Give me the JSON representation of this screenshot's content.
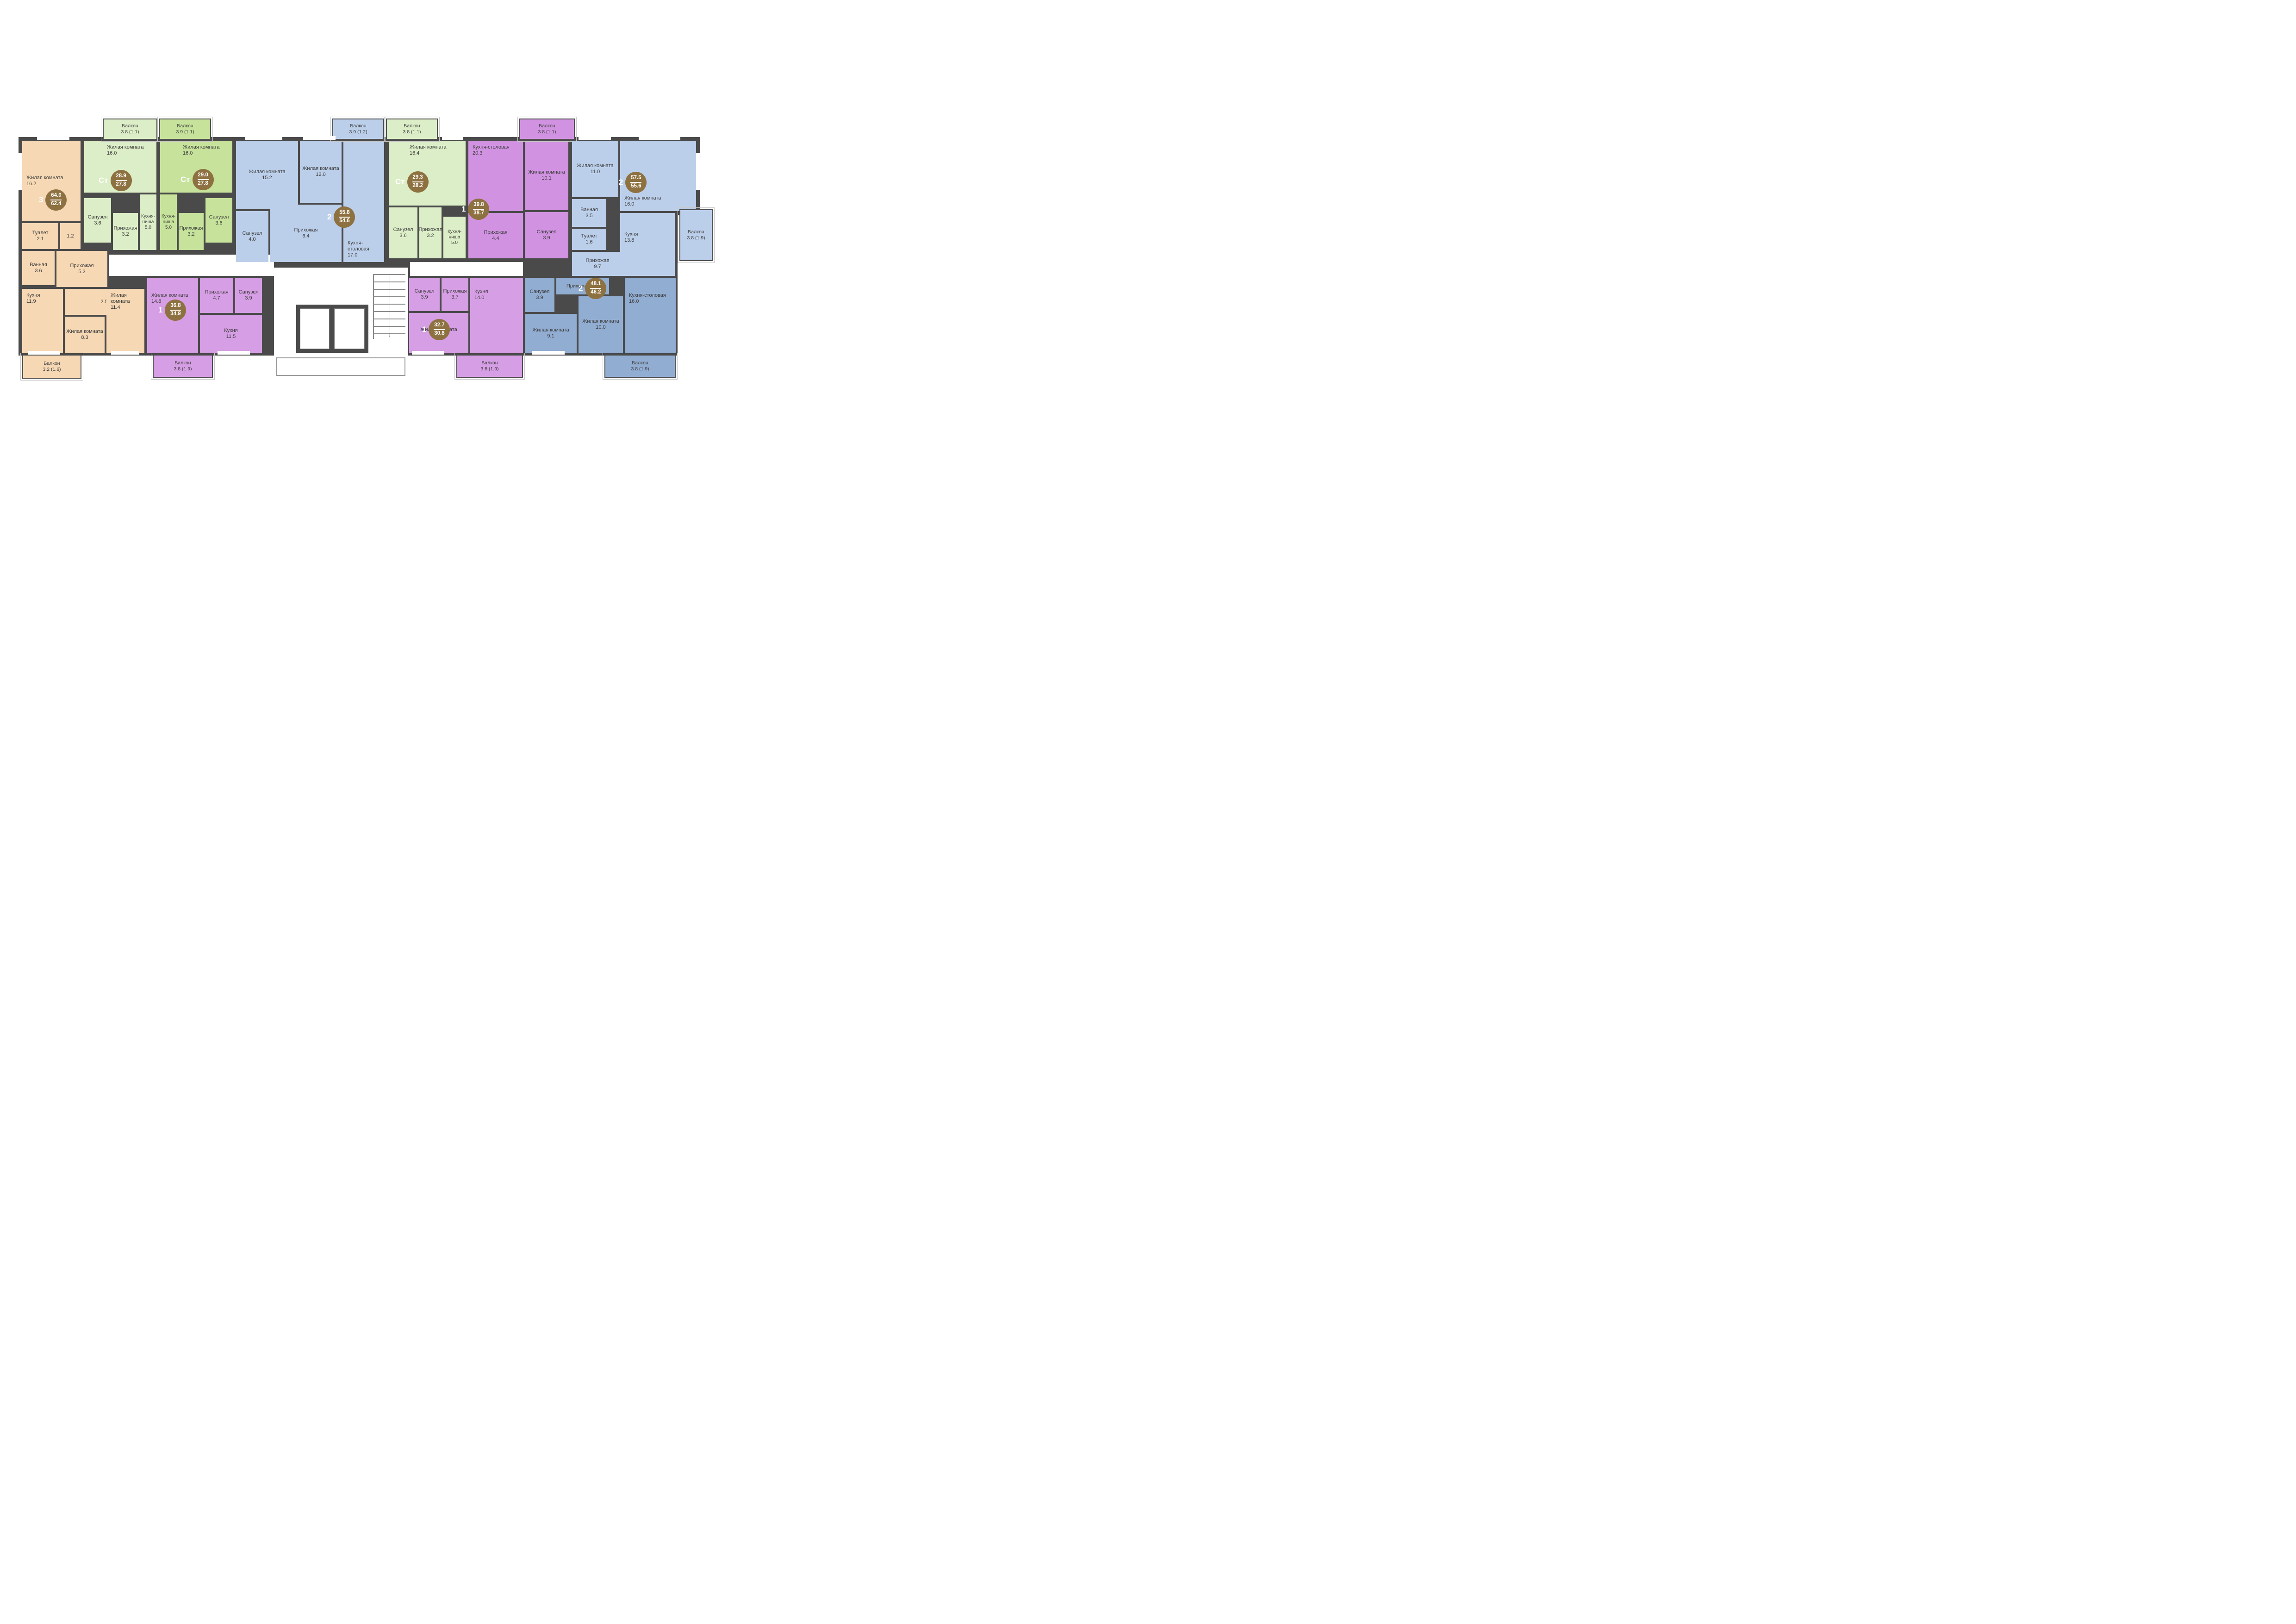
{
  "plan": {
    "wall_color": "#4a4a4a",
    "badge_color": "#8e7140",
    "text_color": "#3c3c3c",
    "apartments": [
      {
        "id": "apt-1",
        "type_label": "3",
        "area_total": "64.0",
        "area_living": "62.4",
        "color": "#f6d8b4",
        "rooms": [
          {
            "name": "Жилая комната",
            "area": "16.2"
          },
          {
            "name": "Туалет",
            "area": "2.1"
          },
          {
            "name": "",
            "area": "1.2"
          },
          {
            "name": "Ванная",
            "area": "3.6"
          },
          {
            "name": "Прихожая",
            "area": "5.2"
          },
          {
            "name": "",
            "area": "2.5"
          },
          {
            "name": "Кухня",
            "area": "11.9"
          },
          {
            "name": "Жилая комната",
            "area": "8.3"
          },
          {
            "name": "Жилая комната",
            "area": "11.4"
          }
        ],
        "balcony": {
          "name": "Балкон",
          "area": "3.2 (1.6)"
        }
      },
      {
        "id": "apt-2",
        "type_label": "Ст",
        "area_total": "28.9",
        "area_living": "27.8",
        "color": "#dceec7",
        "rooms": [
          {
            "name": "Жилая комната",
            "area": "16.0"
          },
          {
            "name": "Санузел",
            "area": "3.6"
          },
          {
            "name": "Прихожая",
            "area": "3.2"
          },
          {
            "name": "Кухня-ниша",
            "area": "5.0"
          }
        ],
        "balcony": {
          "name": "Балкон",
          "area": "3.8 (1.1)"
        }
      },
      {
        "id": "apt-3",
        "type_label": "Ст",
        "area_total": "29.0",
        "area_living": "27.8",
        "color": "#c6e29b",
        "rooms": [
          {
            "name": "Жилая комната",
            "area": "16.0"
          },
          {
            "name": "Кухня-ниша",
            "area": "5.0"
          },
          {
            "name": "Прихожая",
            "area": "3.2"
          },
          {
            "name": "Санузел",
            "area": "3.6"
          }
        ],
        "balcony": {
          "name": "Балкон",
          "area": "3.9 (1.1)"
        }
      },
      {
        "id": "apt-4",
        "type_label": "2",
        "area_total": "55.8",
        "area_living": "54.6",
        "color": "#bccfea",
        "rooms": [
          {
            "name": "Жилая комната",
            "area": "15.2"
          },
          {
            "name": "Жилая комната",
            "area": "12.0"
          },
          {
            "name": "Кухня-столовая",
            "area": "17.0"
          },
          {
            "name": "Санузел",
            "area": "4.0"
          },
          {
            "name": "Прихожая",
            "area": "6.4"
          }
        ],
        "balcony": {
          "name": "Балкон",
          "area": "3.9 (1.2)"
        }
      },
      {
        "id": "apt-5",
        "type_label": "Ст",
        "area_total": "29.3",
        "area_living": "28.2",
        "color": "#dceec7",
        "rooms": [
          {
            "name": "Жилая комната",
            "area": "16.4"
          },
          {
            "name": "Санузел",
            "area": "3.6"
          },
          {
            "name": "Прихожая",
            "area": "3.2"
          },
          {
            "name": "Кухня-ниша",
            "area": "5.0"
          }
        ],
        "balcony": {
          "name": "Балкон",
          "area": "3.8 (1.1)"
        }
      },
      {
        "id": "apt-6",
        "type_label": "1",
        "area_total": "39.8",
        "area_living": "38.7",
        "color": "#d193e1",
        "rooms": [
          {
            "name": "Кухня-столовая",
            "area": "20.3"
          },
          {
            "name": "Жилая комната",
            "area": "10.1"
          },
          {
            "name": "Прихожая",
            "area": "4.4"
          },
          {
            "name": "Санузел",
            "area": "3.9"
          }
        ],
        "balcony": {
          "name": "Балкон",
          "area": "3.8 (1.1)"
        }
      },
      {
        "id": "apt-7",
        "type_label": "2",
        "area_total": "57.5",
        "area_living": "55.6",
        "color": "#bccfea",
        "rooms": [
          {
            "name": "Жилая комната",
            "area": "11.0"
          },
          {
            "name": "Жилая комната",
            "area": "16.0"
          },
          {
            "name": "Ванная",
            "area": "3.5"
          },
          {
            "name": "Туалет",
            "area": "1.6"
          },
          {
            "name": "Прихожая",
            "area": "9.7"
          },
          {
            "name": "Кухня",
            "area": "13.8"
          }
        ],
        "balcony": {
          "name": "Балкон",
          "area": "3.8 (1.9)"
        }
      },
      {
        "id": "apt-8",
        "type_label": "1",
        "area_total": "36.8",
        "area_living": "34.9",
        "color": "#d69ee4",
        "rooms": [
          {
            "name": "Жилая комната",
            "area": "14.8"
          },
          {
            "name": "Прихожая",
            "area": "4.7"
          },
          {
            "name": "Санузел",
            "area": "3.9"
          },
          {
            "name": "Кухня",
            "area": "11.5"
          }
        ],
        "balcony": {
          "name": "Балкон",
          "area": "3.8 (1.9)"
        }
      },
      {
        "id": "apt-9",
        "type_label": "1",
        "area_total": "32.7",
        "area_living": "30.8",
        "color": "#d69ee4",
        "rooms": [
          {
            "name": "Санузел",
            "area": "3.9"
          },
          {
            "name": "Прихожая",
            "area": "3.7"
          },
          {
            "name": "Кухня",
            "area": "14.0"
          },
          {
            "name": "Жилая комната",
            "area": "9.2"
          }
        ],
        "balcony": {
          "name": "Балкон",
          "area": "3.8 (1.9)"
        }
      },
      {
        "id": "apt-10",
        "type_label": "2",
        "area_total": "48.1",
        "area_living": "46.2",
        "color": "#92add2",
        "rooms": [
          {
            "name": "Санузел",
            "area": "3.9"
          },
          {
            "name": "Прихожая",
            "area": "7.2"
          },
          {
            "name": "Жилая комната",
            "area": "9.1"
          },
          {
            "name": "Жилая комната",
            "area": "10.0"
          },
          {
            "name": "Кухня-столовая",
            "area": "16.0"
          }
        ],
        "balcony": {
          "name": "Балкон",
          "area": "3.8 (1.9)"
        }
      }
    ]
  }
}
